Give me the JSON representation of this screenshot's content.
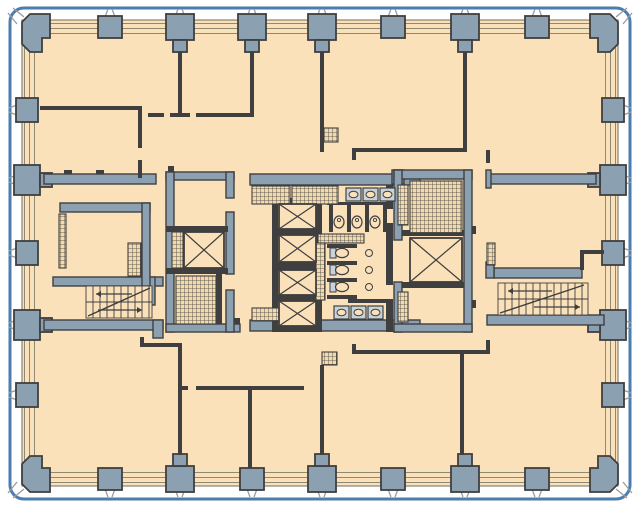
{
  "title": "office-tower-typical-floor-plan",
  "canvas": {
    "width": 640,
    "height": 507,
    "background": "#FFFFFF"
  },
  "colors": {
    "floor": "#FAE1BA",
    "hatch_base": "#F2DAAF",
    "column_fill": "#8BA0B1",
    "wall_dark": "#3F3F3F",
    "band_line": "#8D8A74",
    "floor_edge": "#6E6B5C",
    "border_blue": "#4B7DAE",
    "fork_gray": "#9B9B9B",
    "fixture_fill": "#C8D2DA"
  },
  "border": {
    "x": 10,
    "y": 8,
    "w": 620,
    "h": 491,
    "r": 14,
    "stroke_w": 3
  },
  "floor_slab": {
    "x": 22,
    "y": 20,
    "w": 596,
    "h": 466
  },
  "bands": {
    "top_lines_y": [
      23.5,
      28.5,
      33.5
    ],
    "bottom_lines_y": [
      472.5,
      477.5,
      482.5
    ],
    "left_lines_x": [
      24.5,
      29.5,
      34.5
    ],
    "right_lines_x": [
      605.5,
      610.5,
      615.5
    ]
  },
  "columns": {
    "top": {
      "small_cx": [
        110,
        393,
        537
      ],
      "large_cx": [
        180,
        252,
        322,
        465
      ]
    },
    "bottom": {
      "small_cx": [
        110,
        252,
        393,
        537
      ],
      "large_cx": [
        180,
        322,
        465
      ]
    },
    "left": {
      "small_cy": [
        110,
        253,
        395
      ],
      "large_cy": [
        180,
        325
      ]
    },
    "right": {
      "small_cy": [
        110,
        253,
        395
      ],
      "large_cy": [
        180,
        325
      ]
    },
    "corner_paths": [
      "M30,14 L50,14 L50,38 L42,38 L42,52 L30,52 L22,44 L22,22 Z",
      "M610,14 L590,14 L590,38 L598,38 L598,52 L610,52 L618,44 L618,22 Z",
      "M30,492 L50,492 L50,468 L42,468 L42,456 L30,456 L22,464 L22,484 Z",
      "M610,492 L590,492 L590,468 L598,468 L598,456 L610,456 L618,464 L618,484 Z"
    ]
  },
  "forks": {
    "top_cx": [
      110,
      180,
      252,
      322,
      393,
      465,
      537
    ],
    "bottom_cx": [
      110,
      180,
      252,
      322,
      393,
      465,
      537
    ],
    "left_cy": [
      110,
      180,
      253,
      325,
      395
    ],
    "right_cy": [
      110,
      180,
      253,
      325,
      395
    ],
    "corner_lines": [
      [
        24,
        17,
        13,
        8
      ],
      [
        17,
        24,
        8,
        13
      ],
      [
        616,
        17,
        627,
        8
      ],
      [
        623,
        24,
        632,
        13
      ],
      [
        17,
        482,
        8,
        493
      ],
      [
        24,
        489,
        13,
        498
      ],
      [
        623,
        482,
        632,
        493
      ],
      [
        616,
        489,
        627,
        498
      ]
    ]
  },
  "walls_thin": [
    [
      40,
      106,
      102,
      4
    ],
    [
      138,
      106,
      4,
      42
    ],
    [
      138,
      160,
      4,
      18
    ],
    [
      148,
      113,
      16,
      4
    ],
    [
      170,
      113,
      20,
      4
    ],
    [
      178,
      52,
      4,
      61
    ],
    [
      196,
      113,
      58,
      4
    ],
    [
      250,
      52,
      4,
      65
    ],
    [
      320,
      52,
      4,
      100
    ],
    [
      352,
      148,
      112,
      4
    ],
    [
      352,
      152,
      4,
      8
    ],
    [
      463,
      52,
      4,
      100
    ],
    [
      486,
      150,
      4,
      13
    ],
    [
      580,
      250,
      24,
      4
    ],
    [
      580,
      250,
      4,
      20
    ],
    [
      64,
      170,
      8,
      4
    ],
    [
      96,
      170,
      8,
      4
    ],
    [
      140,
      337,
      4,
      6
    ],
    [
      140,
      343,
      42,
      4
    ],
    [
      178,
      343,
      4,
      112
    ],
    [
      182,
      386,
      6,
      4
    ],
    [
      196,
      386,
      108,
      4
    ],
    [
      248,
      390,
      4,
      78
    ],
    [
      320,
      365,
      4,
      90
    ],
    [
      352,
      344,
      4,
      6
    ],
    [
      352,
      350,
      138,
      4
    ],
    [
      486,
      340,
      4,
      10
    ],
    [
      460,
      354,
      4,
      101
    ],
    [
      386,
      185,
      7,
      24
    ],
    [
      386,
      223,
      7,
      62
    ],
    [
      386,
      299,
      7,
      33
    ],
    [
      327,
      202,
      60,
      3
    ],
    [
      329,
      204,
      4,
      28
    ],
    [
      347,
      204,
      4,
      28
    ],
    [
      365,
      204,
      4,
      28
    ],
    [
      383,
      204,
      4,
      28
    ],
    [
      327,
      244,
      30,
      4
    ],
    [
      327,
      261,
      30,
      4
    ],
    [
      327,
      278,
      30,
      4
    ],
    [
      327,
      295,
      30,
      4
    ],
    [
      348,
      299,
      44,
      4
    ],
    [
      272,
      198,
      6,
      134
    ],
    [
      316,
      198,
      6,
      134
    ],
    [
      272,
      198,
      50,
      6
    ],
    [
      272,
      229,
      50,
      6
    ],
    [
      272,
      262,
      50,
      8
    ],
    [
      272,
      295,
      50,
      6
    ],
    [
      272,
      326,
      50,
      6
    ],
    [
      166,
      226,
      62,
      6
    ],
    [
      166,
      268,
      62,
      6
    ],
    [
      216,
      274,
      6,
      50
    ],
    [
      402,
      230,
      62,
      6
    ],
    [
      402,
      282,
      62,
      6
    ],
    [
      472,
      226,
      4,
      8
    ],
    [
      472,
      300,
      4,
      8
    ],
    [
      168,
      166,
      6,
      6
    ],
    [
      234,
      318,
      6,
      6
    ]
  ],
  "walls_thick": [
    [
      44,
      174,
      112,
      10
    ],
    [
      53,
      277,
      110,
      9
    ],
    [
      44,
      320,
      119,
      10
    ],
    [
      153,
      320,
      10,
      18
    ],
    [
      148,
      277,
      7,
      28
    ],
    [
      60,
      203,
      90,
      9
    ],
    [
      142,
      203,
      8,
      83
    ],
    [
      166,
      172,
      68,
      8
    ],
    [
      166,
      172,
      8,
      160
    ],
    [
      166,
      324,
      74,
      8
    ],
    [
      226,
      172,
      8,
      26
    ],
    [
      226,
      212,
      8,
      62
    ],
    [
      226,
      290,
      8,
      42
    ],
    [
      250,
      174,
      170,
      11
    ],
    [
      250,
      320,
      170,
      11
    ],
    [
      392,
      170,
      12,
      14
    ],
    [
      394,
      170,
      78,
      9
    ],
    [
      394,
      170,
      8,
      70
    ],
    [
      394,
      282,
      8,
      50
    ],
    [
      464,
      170,
      8,
      162
    ],
    [
      394,
      324,
      78,
      8
    ],
    [
      490,
      174,
      106,
      10
    ],
    [
      486,
      170,
      5,
      18
    ],
    [
      494,
      268,
      88,
      10
    ],
    [
      486,
      262,
      8,
      16
    ],
    [
      487,
      315,
      117,
      10
    ]
  ],
  "hatches": [
    [
      252,
      186,
      38,
      18
    ],
    [
      292,
      186,
      46,
      18
    ],
    [
      318,
      234,
      46,
      9
    ],
    [
      316,
      243,
      9,
      57
    ],
    [
      252,
      308,
      38,
      13
    ],
    [
      292,
      308,
      20,
      13
    ],
    [
      172,
      232,
      11,
      36
    ],
    [
      176,
      276,
      40,
      48
    ],
    [
      410,
      181,
      52,
      52
    ],
    [
      398,
      185,
      10,
      40
    ],
    [
      398,
      292,
      10,
      30
    ],
    [
      128,
      243,
      13,
      33
    ],
    [
      59,
      214,
      7,
      54
    ],
    [
      487,
      243,
      8,
      22
    ],
    [
      324,
      128,
      14,
      14
    ],
    [
      322,
      352,
      15,
      13
    ]
  ],
  "elevators": [
    [
      184,
      232,
      40,
      36
    ],
    [
      279,
      204,
      37,
      25
    ],
    [
      279,
      235,
      37,
      27
    ],
    [
      279,
      270,
      37,
      25
    ],
    [
      279,
      301,
      37,
      25
    ],
    [
      410,
      238,
      52,
      44
    ]
  ],
  "stairs": [
    {
      "x": 86,
      "y": 286,
      "w": 66,
      "h": 32,
      "mid": 302,
      "step": 7,
      "diag": [
        88,
        316,
        150,
        288
      ],
      "arrows": [
        {
          "x1": 132,
          "y1": 294,
          "x2": 96,
          "y2": 294
        },
        {
          "x1": 98,
          "y1": 310,
          "x2": 142,
          "y2": 310
        }
      ]
    },
    {
      "x": 498,
      "y": 283,
      "w": 90,
      "h": 32,
      "mid": 299,
      "step": 7,
      "diag": [
        500,
        313,
        584,
        285
      ],
      "arrows": [
        {
          "x1": 552,
          "y1": 291,
          "x2": 508,
          "y2": 291
        },
        {
          "x1": 534,
          "y1": 307,
          "x2": 580,
          "y2": 307
        }
      ]
    }
  ],
  "fixtures": {
    "sinks": [
      [
        346,
        188,
        15,
        13
      ],
      [
        363,
        188,
        15,
        13
      ],
      [
        380,
        188,
        15,
        13
      ],
      [
        334,
        306,
        15,
        13
      ],
      [
        351,
        306,
        15,
        13
      ],
      [
        368,
        306,
        15,
        13
      ]
    ],
    "urinals": [
      [
        339,
        222
      ],
      [
        357,
        222
      ],
      [
        375,
        222
      ]
    ],
    "toilets": [
      [
        342,
        253
      ],
      [
        342,
        270
      ],
      [
        342,
        287
      ]
    ],
    "circles": [
      [
        369,
        253
      ],
      [
        369,
        270
      ],
      [
        369,
        287
      ]
    ]
  }
}
